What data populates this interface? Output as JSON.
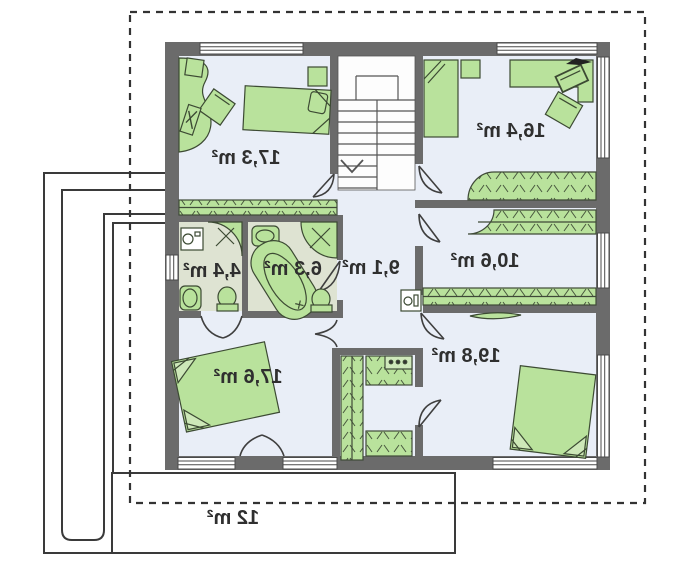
{
  "plan": {
    "type": "floor-plan-mirrored",
    "rooms": [
      {
        "id": "bedroom-top-left",
        "label": "17,3 m²"
      },
      {
        "id": "bedroom-top-right",
        "label": "16,4 m²"
      },
      {
        "id": "wc",
        "label": "4,4 m²"
      },
      {
        "id": "bathroom",
        "label": "6,3 m²"
      },
      {
        "id": "hall",
        "label": "9,1 m²"
      },
      {
        "id": "wardrobe-room",
        "label": "10,6 m²"
      },
      {
        "id": "bedroom-bottom-left",
        "label": "17,6 m²"
      },
      {
        "id": "bedroom-bottom-right",
        "label": "19,8 m²"
      },
      {
        "id": "balcony",
        "label": "12 m²"
      }
    ],
    "colors": {
      "wall": "#6b6b6b",
      "floor": "#e9eef7",
      "bathroom_floor": "#dee3d2",
      "furniture": "#b9e29c",
      "line": "#3a3a3a",
      "background": "#ffffff"
    }
  }
}
